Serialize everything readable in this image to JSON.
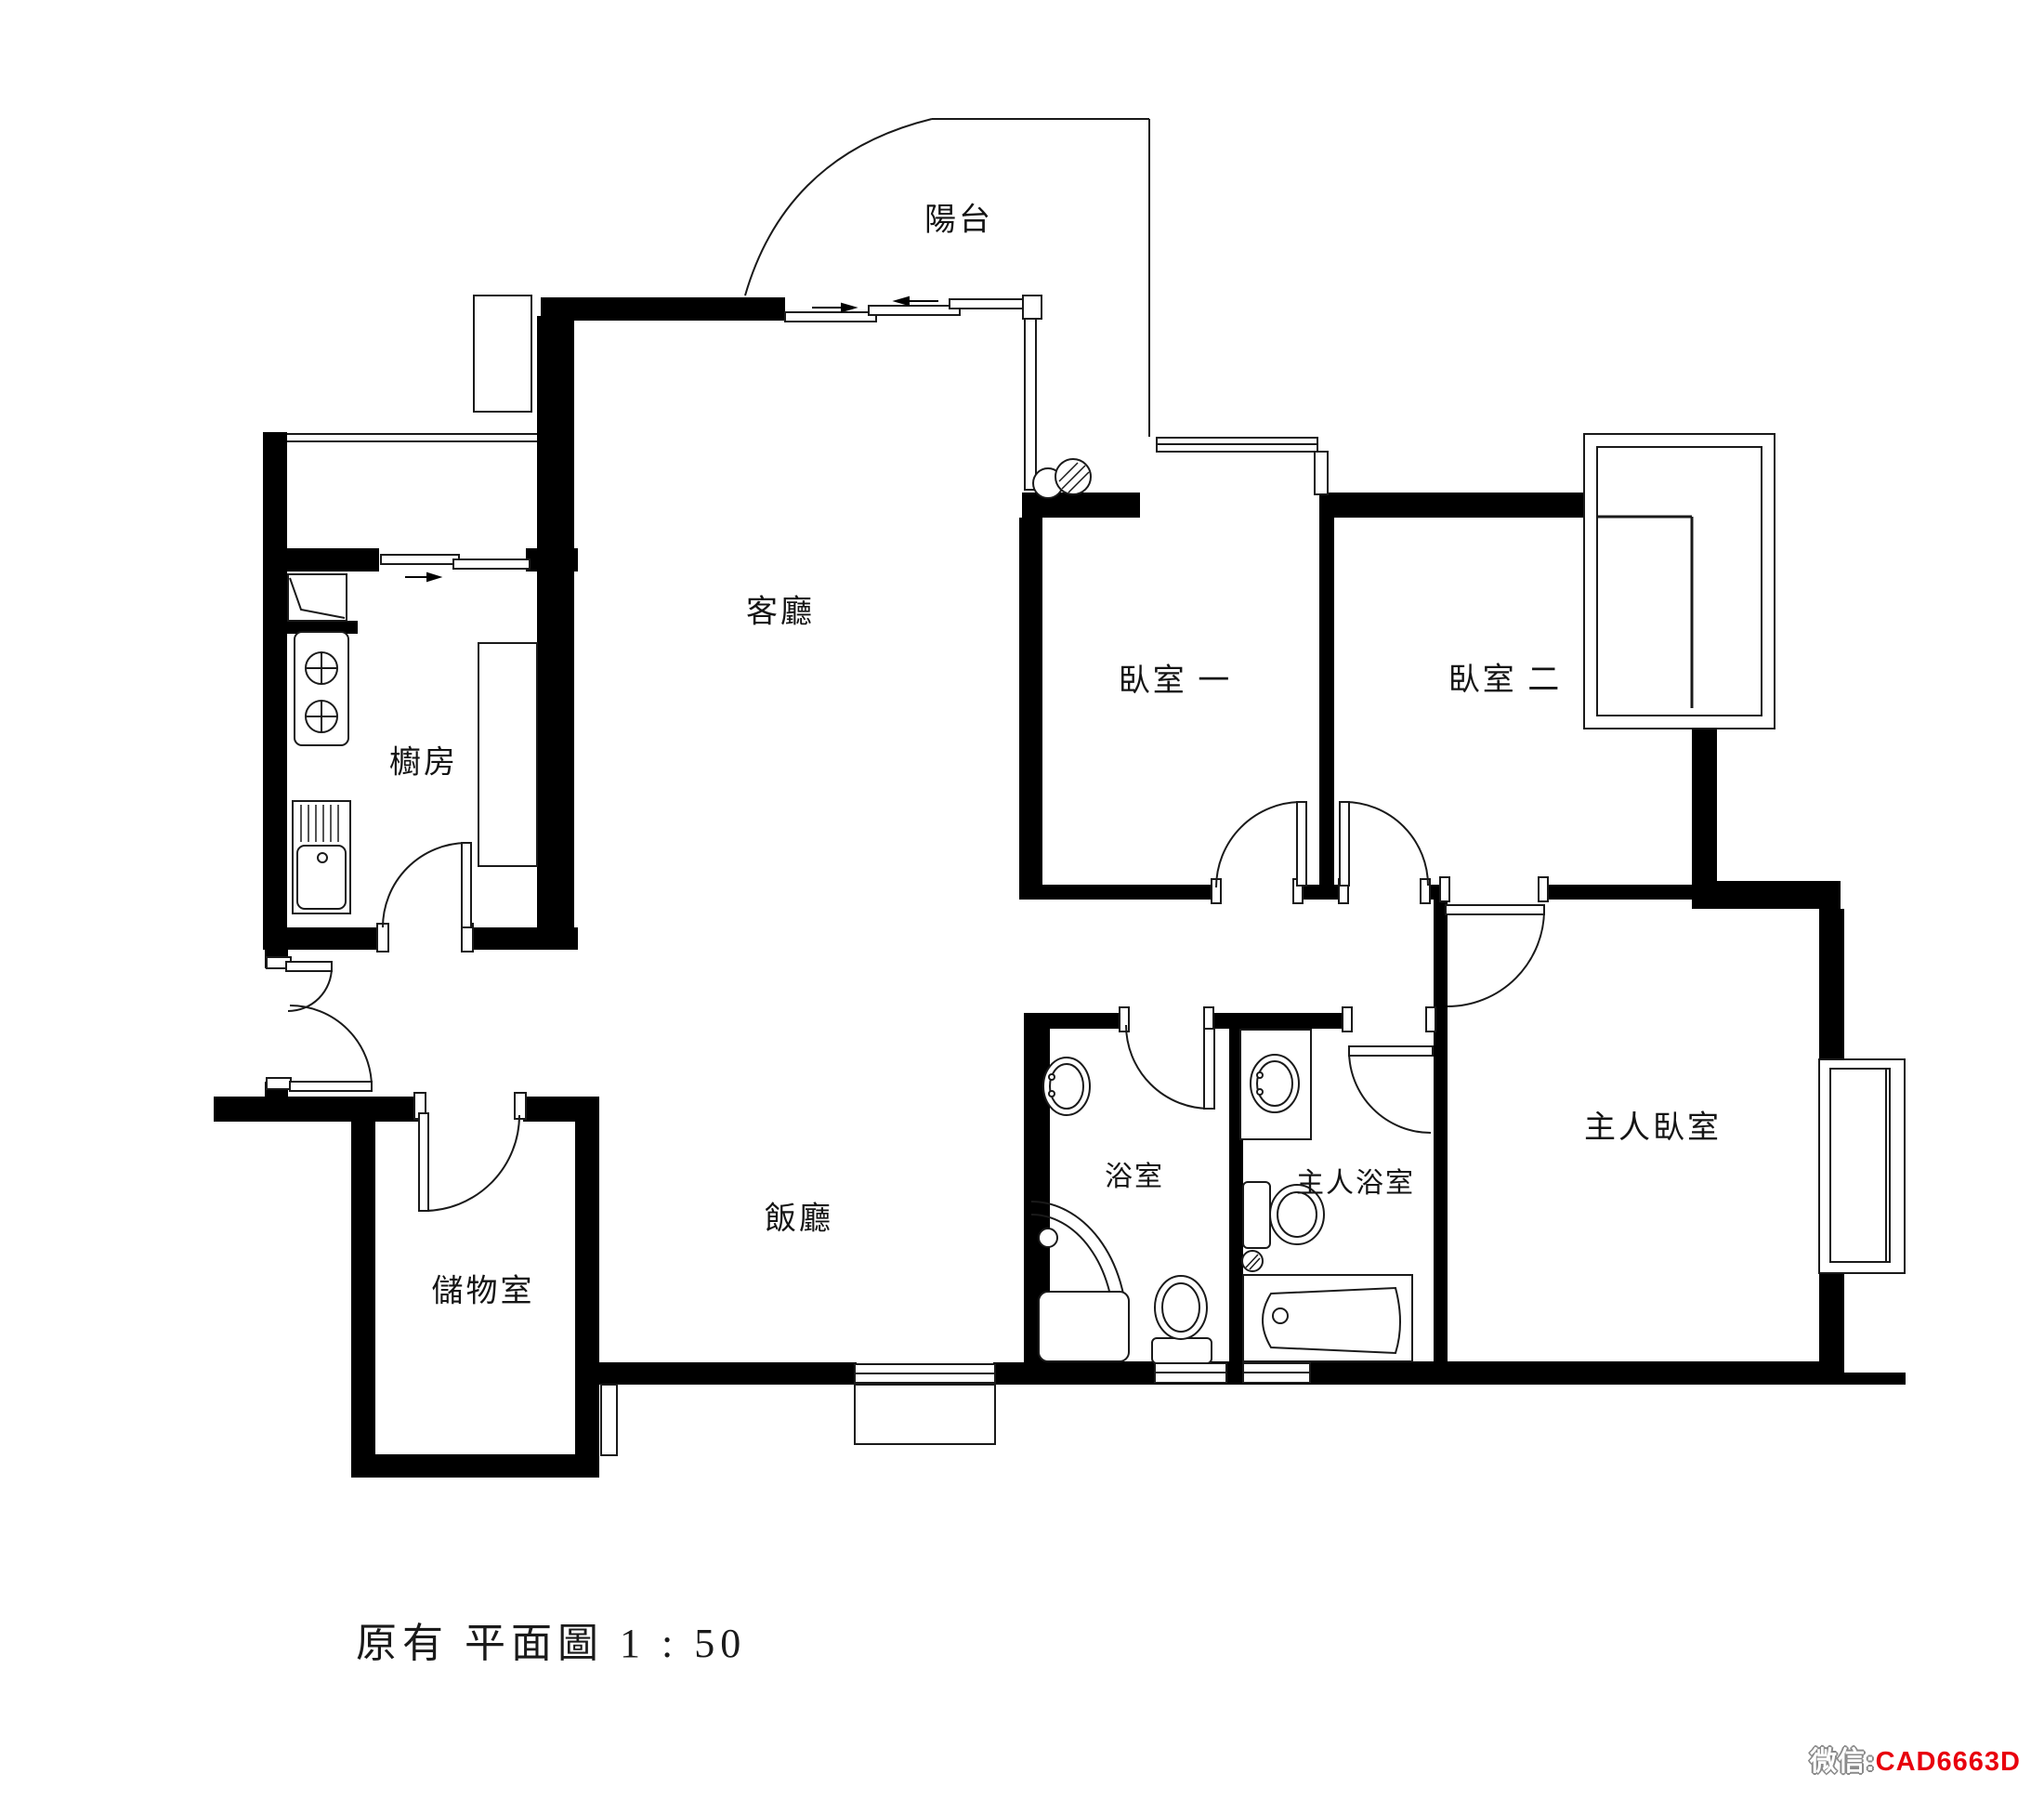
{
  "rooms": {
    "balcony": {
      "label": "陽台"
    },
    "living": {
      "label": "客廳"
    },
    "bedroom1": {
      "label": "臥室 一"
    },
    "bedroom2": {
      "label": "臥室 二"
    },
    "kitchen": {
      "label": "櫥房"
    },
    "bathroom": {
      "label": "浴室"
    },
    "master_bathroom": {
      "label": "主人浴室"
    },
    "master_bedroom": {
      "label": "主人臥室"
    },
    "dining": {
      "label": "飯廳"
    },
    "storage": {
      "label": "儲物室"
    }
  },
  "title_block": {
    "text": "原有 平面圖  1 : 50"
  },
  "watermark": {
    "prefix": "微信:",
    "code": "CAD6663D",
    "code_color": "#e8000d",
    "prefix_color": "#8a8a8a"
  },
  "colors": {
    "wall": "#000000",
    "line": "#1a1a1a",
    "background": "#ffffff"
  }
}
